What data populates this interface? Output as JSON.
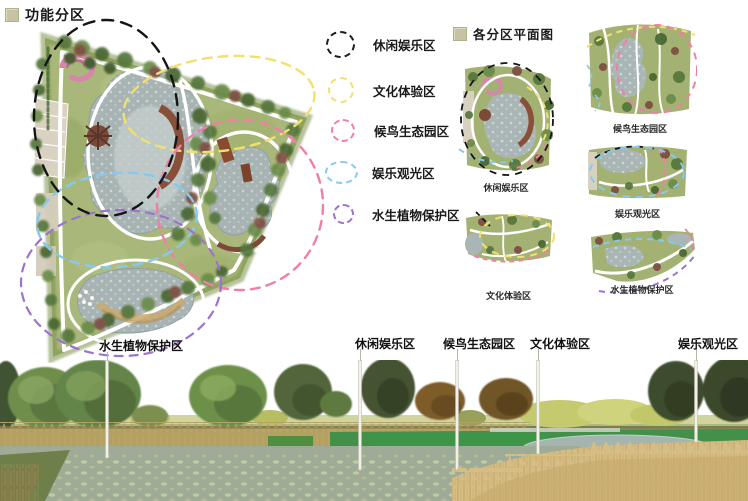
{
  "page": {
    "background": "#ffffff"
  },
  "header": {
    "title": "功能分区",
    "bullet_color": "#c6c3a4"
  },
  "zone_plans_header": {
    "title": "各分区平面图",
    "bullet_color": "#c6c3a4"
  },
  "legend": {
    "items": [
      {
        "id": "leisure",
        "label": "休闲娱乐区",
        "color": "#1c1c1c"
      },
      {
        "id": "culture",
        "label": "文化体验区",
        "color": "#f2e06e"
      },
      {
        "id": "bird",
        "label": "候鸟生态园区",
        "color": "#f07fa6"
      },
      {
        "id": "sightseeing",
        "label": "娱乐观光区",
        "color": "#86c9f0"
      },
      {
        "id": "aquatic",
        "label": "水生植物保护区",
        "color": "#9b74cd"
      }
    ]
  },
  "master_plan": {
    "zone_label": "水生植物保护区"
  },
  "thumbnails": [
    {
      "caption": "休闲娱乐区"
    },
    {
      "caption": "候鸟生态园区"
    },
    {
      "caption": "娱乐观光区"
    },
    {
      "caption": "文化体验区"
    },
    {
      "caption": "水生植物保护区"
    }
  ],
  "section": {
    "labels": [
      "休闲娱乐区",
      "候鸟生态园区",
      "文化体验区",
      "娱乐观光区"
    ]
  }
}
